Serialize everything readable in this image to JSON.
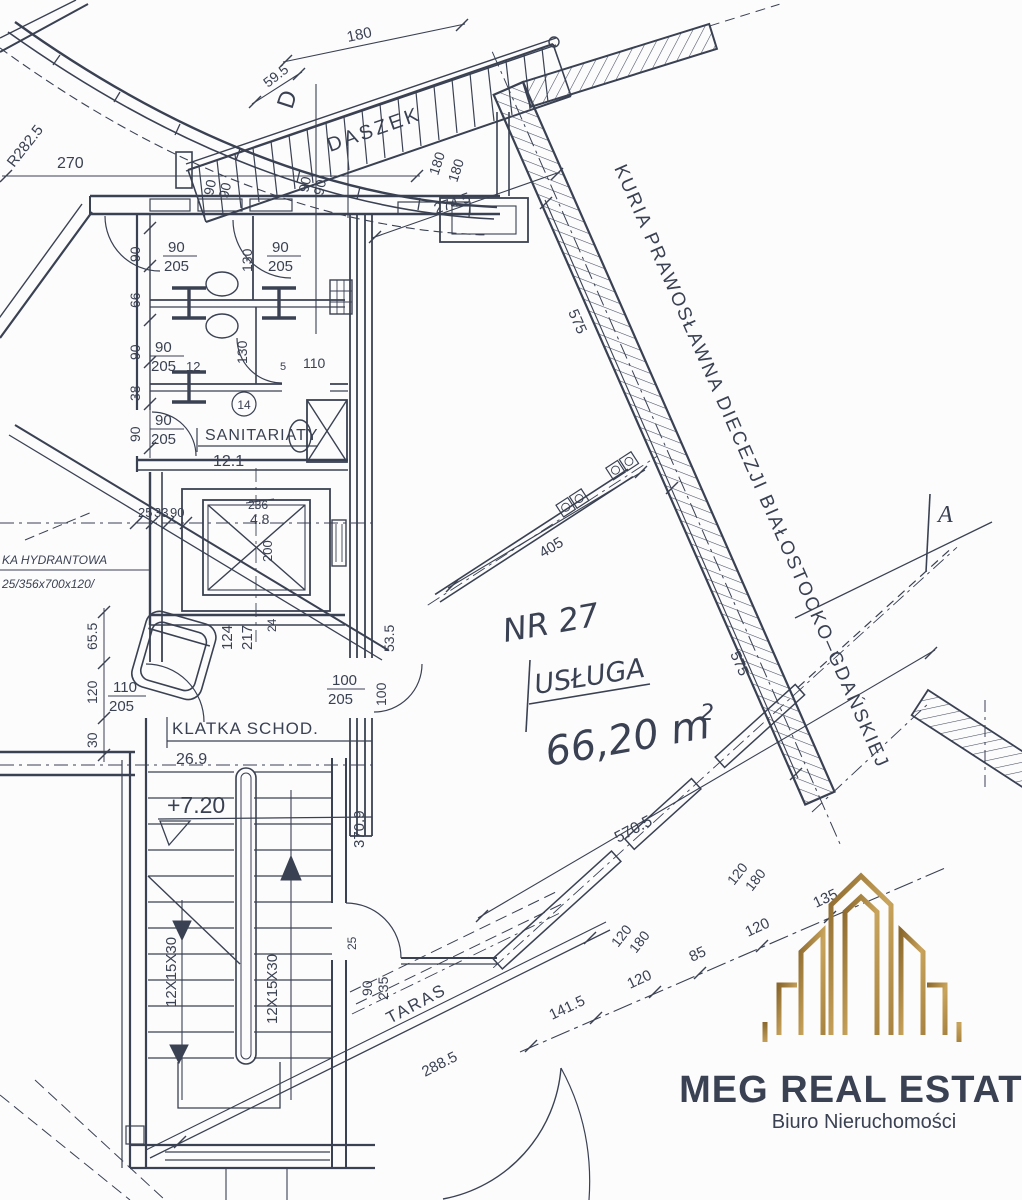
{
  "drawing": {
    "site_text": {
      "kuria": "KURIA PRAWOSŁAWNA DIECEZJI BIAŁOSTOCKO–GDAŃSKIEJ",
      "hydrant_cabinet": "KA HYDRANTOWA",
      "hydrant_spec": "25/356x700x120/"
    },
    "rooms": {
      "daszek": "DASZEK",
      "sanitariaty": "SANITARIATY",
      "sanitariaty_area": "12.1",
      "klatka": "KLATKA SCHOD.",
      "klatka_area": "26.9",
      "taras": "TARAS",
      "unit_no": "NR 27",
      "unit_use": "USŁUGA",
      "unit_area": "66,20 m",
      "unit_area_sup": "2",
      "level": "+7.20"
    },
    "sections": {
      "a": "A",
      "d": "D"
    },
    "dims": {
      "r282": "R282.5",
      "d270": "270",
      "d180": "180",
      "d59_5": "59.5",
      "d90": "90",
      "d205": "205",
      "d274_5": "274.5",
      "d575": "575",
      "d130": "130",
      "d66": "66",
      "d38": "38",
      "d110": "110",
      "d12": "12",
      "d5": "5",
      "d14": "14",
      "d25": "25",
      "d33": "33",
      "d236": "236",
      "d4_8": "4.8",
      "d200": "200",
      "d124": "124",
      "d217": "217",
      "d24": "24",
      "d65_5": "65.5",
      "d120": "120",
      "d30": "30",
      "d100": "100",
      "d53_5": "53.5",
      "d370_9": "370.9",
      "d235": "235",
      "d288_5": "288.5",
      "d405": "405",
      "d570_5": "570.5",
      "d141_5": "141.5",
      "d85": "85",
      "d135": "135",
      "stairs_spec": "12X15X30"
    }
  },
  "logo": {
    "title": "MEG REAL ESTATE",
    "subtitle": "Biuro Nieruchomości",
    "gold_dark": "#8a672c",
    "gold_mid": "#c9a45c",
    "gold_deep": "#a98441",
    "subtitle_color": "#c29b52",
    "ink": "#3a4152"
  }
}
